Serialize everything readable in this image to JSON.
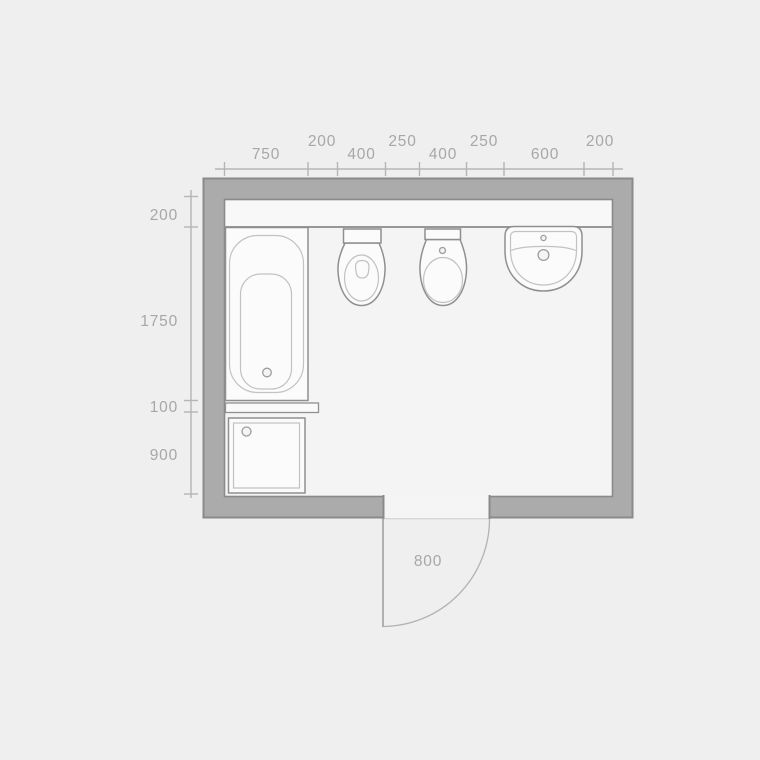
{
  "plan": {
    "title": "bathroom-floor-plan",
    "dimensions_top": [
      "750",
      "200",
      "400",
      "250",
      "400",
      "250",
      "600",
      "200"
    ],
    "dimensions_left": [
      "200",
      "1750",
      "100",
      "900"
    ],
    "door_width": "800",
    "fixtures": [
      "bathtub",
      "toilet",
      "bidet",
      "washbasin",
      "shower-tray",
      "shelf-ledge",
      "door-swing"
    ],
    "colors": {
      "background": "#efefef",
      "floor": "#f4f4f4",
      "wall_fill": "#ababab",
      "wall_stroke": "#8a8a8a",
      "fixture_fill": "#fbfbfb",
      "fixture_stroke": "#8f8f8f",
      "detail_stroke": "#c2c2c2",
      "dimension_line": "#b5b5b5",
      "dimension_text": "#a7a7a7"
    }
  }
}
